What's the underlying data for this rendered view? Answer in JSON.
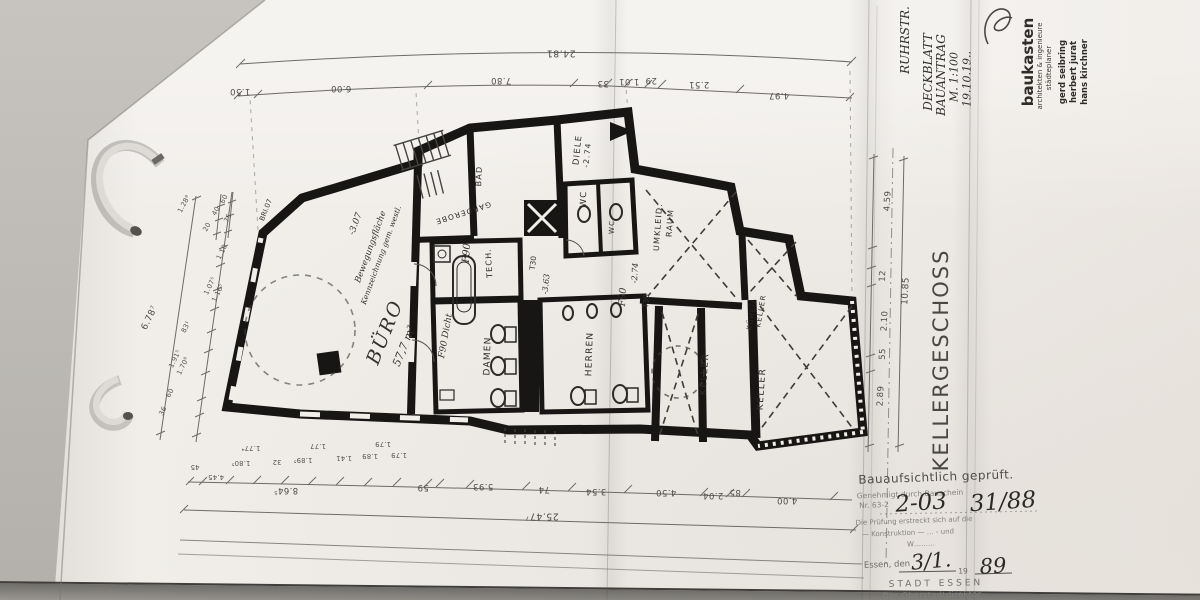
{
  "sheet": {
    "drawing_title": "KELLERGESCHOSS",
    "paper_color": "#f1eeea",
    "background_color": "#bdbab6",
    "ink_color": "#1a1a1a"
  },
  "corner_notes": {
    "line1": "RUHRSTR.",
    "line2": "DECKBLATT",
    "line3": "BAUANTRAG",
    "line4": "M. 1:100",
    "line5": "19.10.19.."
  },
  "firm_stamp": {
    "name": "baukasten",
    "line2": "architekten & ingenieure",
    "line3": "städteplaner",
    "partner1": "gerd seibring",
    "partner2": "herbert jurat",
    "partner3": "hans kirchner"
  },
  "rooms": {
    "buero": {
      "label": "BÜRO",
      "area": "57,7 m²"
    },
    "damen": {
      "label": "DAMEN"
    },
    "herren": {
      "label": "HERREN"
    },
    "diele": {
      "label": "DIELE",
      "level": "-2.74"
    },
    "wc1": {
      "label": "WC"
    },
    "wc2": {
      "label": "WC"
    },
    "bad": {
      "label": "BAD"
    },
    "garderobe": {
      "label": "GARDEROBE"
    },
    "technik": {
      "label": "TECH."
    },
    "umkleide": {
      "label": "UMKLEID.",
      "label2": "RAUM"
    },
    "kuehlkeller": {
      "label": "KÜHL-/",
      "label2": "KELLER"
    },
    "keller1": {
      "label": "KELLER"
    },
    "keller2": {
      "label": "KELLER"
    }
  },
  "plan_notes": {
    "hand_note1": "Bewegungsfläche",
    "hand_note2": "Kennzeichnung gem. westl.",
    "level_buero": "-3.07",
    "level_tech": "-3.63",
    "level_umkleide": "-2.74",
    "wall_label": "BRI.07",
    "door_t30_a": "T30",
    "door_t30_b": "T30",
    "fire_f90_a": "F90",
    "fire_f90_b": "F90 Dicht",
    "fire_f90_c": "F90"
  },
  "dims": {
    "top": {
      "overall": "24.81",
      "d1": "1.50",
      "d2": "6.00",
      "d3": "7.80",
      "d4": "33",
      "d5": "1.01",
      "d6": "29",
      "d7": "2.51",
      "d8": "4.97"
    },
    "bottom": {
      "overall": "25.47⁷",
      "m1": "8.64⁵",
      "m2": "59",
      "m3": "5.93",
      "m4": "74",
      "m5": "3.54",
      "m6": "4.50",
      "m7": "2.04",
      "m8": "85",
      "m9": "4.00",
      "s1": "45",
      "s2": "4.45",
      "s3": "1.80⁵",
      "s4": "32",
      "s5": "1.89⁵",
      "s6": "1.41",
      "s7": "1.89",
      "s8": "1.79",
      "t1": "1.77⁴",
      "t2": "1.77",
      "t3": "1.79"
    },
    "left": {
      "overall": "6.78⁷",
      "d1": "36",
      "d2": "60",
      "d3": "1.91⁵",
      "d4": "1.70⁸",
      "d5": "83¹",
      "d6": "1.07⁵",
      "d7": "1.16⁵",
      "d8": "1.10",
      "u1": "1.28⁸",
      "u2": "20",
      "u3": "40",
      "u4": "75",
      "u5": "60"
    },
    "right": {
      "overall": "10.85",
      "d1": "2.89",
      "d2": "55",
      "d3": "2.10",
      "d4": "12",
      "d5": "4.59"
    }
  },
  "stamp": {
    "line1": "Bauaufsichtlich geprüft.",
    "line2": "Genehmigt durch Bauschein",
    "line3": "Nr. 63-2",
    "hand_no": "2-03",
    "hand_no2": "31/88",
    "line4": "Die Prüfung erstreckt sich auf die",
    "line5": "— Konstruktion —  …  - und",
    "line6": "W………",
    "essen_line": "Essen, den",
    "hand_date": "3/1.",
    "year_prefix": "19",
    "hand_year": "89",
    "authority1": "STADT ESSEN",
    "authority2": "Der Oberstadtdirektor"
  }
}
